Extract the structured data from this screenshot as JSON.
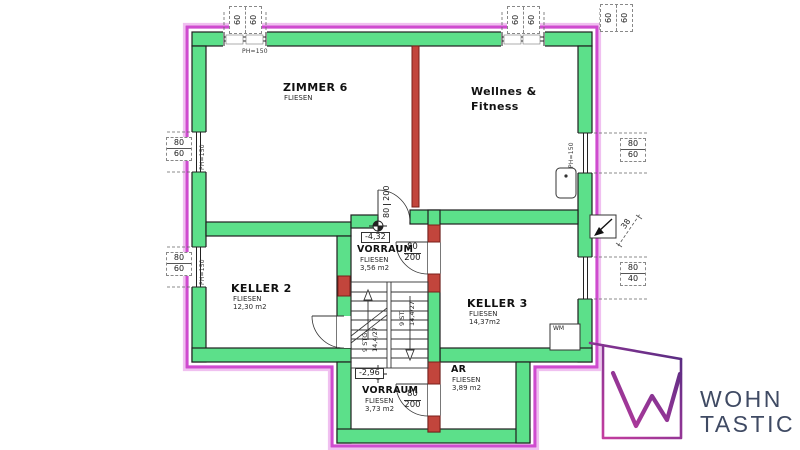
{
  "colors": {
    "wall_green": "#5ce08a",
    "outline": "#1f1f1f",
    "insulation_magenta": "#cf4bcf",
    "insulation_light": "#f0c0f0",
    "masonry_red": "#c2453c",
    "logo_purple": "#4f2a7e",
    "logo_magenta": "#c93ea0",
    "logo_text": "#3f4a63"
  },
  "rooms": {
    "zimmer6": {
      "name": "ZIMMER 6",
      "finish": "FLIESEN"
    },
    "wellness": {
      "line1": "Wellnes &",
      "line2": "Fitness"
    },
    "vorraum_upper": {
      "name": "VORRAUM",
      "finish": "FLIESEN",
      "area": "3,56 m2",
      "level": "-4,32"
    },
    "keller2": {
      "name": "KELLER 2",
      "finish": "FLIESEN",
      "area": "12,30 m2"
    },
    "keller3": {
      "name": "KELLER 3",
      "finish": "FLIESEN",
      "area": "14,37m2"
    },
    "ar": {
      "name": "AR",
      "finish": "FLIESEN",
      "area": "3,89 m2"
    },
    "vorraum_lower": {
      "name": "VORRAUM",
      "finish": "FLIESEN",
      "area": "3,73 m2",
      "level": "-2,96"
    }
  },
  "doors": {
    "top": {
      "w": "80",
      "h": "200"
    },
    "keller3": {
      "w": "80",
      "h": "200"
    },
    "ar": {
      "w": "80",
      "h": "200"
    }
  },
  "windows": {
    "top1": {
      "a": "60",
      "b": "60"
    },
    "top2": {
      "a": "60",
      "b": "60"
    },
    "top3": {
      "a": "60",
      "b": "60"
    },
    "left1": {
      "w": "80",
      "h": "60"
    },
    "left2": {
      "w": "80",
      "h": "60"
    },
    "right1": {
      "w": "80",
      "h": "60"
    },
    "right2": {
      "w": "80",
      "h": "40"
    }
  },
  "labels": {
    "ph": "PH=150",
    "vent_dim": "38",
    "wm": "WM"
  },
  "stairs": {
    "left": {
      "line1": "9 STG.",
      "line2": "14,4/27"
    },
    "right": {
      "line1": "9 ST.",
      "line2": "14,4/27"
    }
  },
  "logo": {
    "line1": "WOHN",
    "line2": "TASTIC"
  }
}
